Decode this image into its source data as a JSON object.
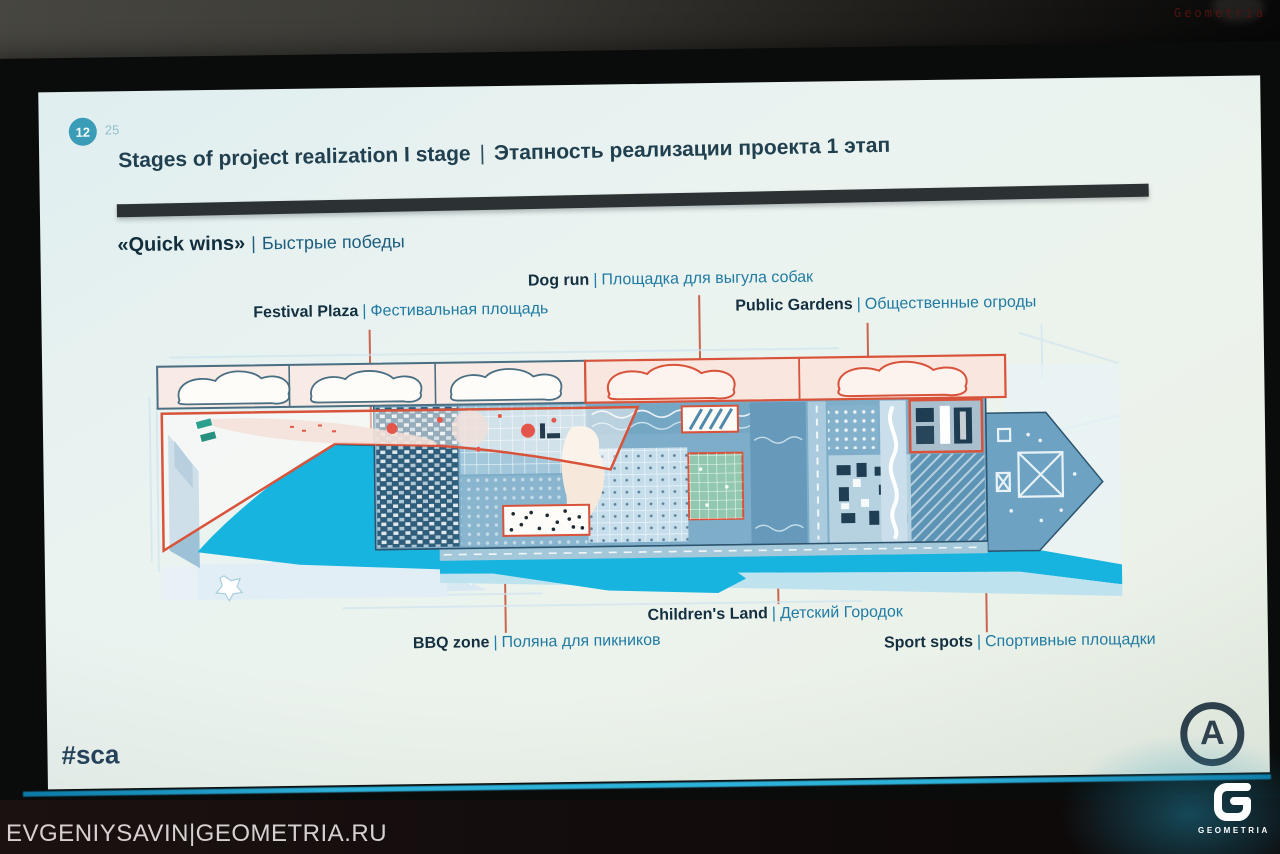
{
  "photo": {
    "corner_brand": "Geometria",
    "watermark": "EVGENIYSAVIN|GEOMETRIA.RU",
    "geometria_logo": {
      "label": "GEOMETRIA"
    }
  },
  "slide": {
    "page": {
      "current": "12",
      "next": "25"
    },
    "title": {
      "en": "Stages of project realization I stage",
      "sep": "|",
      "ru": "Этапность реализации проекта 1 этап"
    },
    "subtitle": {
      "en": "«Quick wins»",
      "sep": "|",
      "ru": "Быстрые победы"
    },
    "map_labels": {
      "dog_run": {
        "en": "Dog run",
        "sep": "|",
        "ru": "Площадка для выгула собак"
      },
      "festival_plaza": {
        "en": "Festival Plaza",
        "sep": "|",
        "ru": "Фестивальная площадь"
      },
      "public_gardens": {
        "en": "Public Gardens",
        "sep": "|",
        "ru": "Общественные огроды"
      },
      "childrens_land": {
        "en": "Children's Land",
        "sep": "|",
        "ru": "Детский Городок"
      },
      "bbq_zone": {
        "en": "BBQ zone",
        "sep": "|",
        "ru": "Поляна для пикников"
      },
      "sport_spots": {
        "en": "Sport spots",
        "sep": "|",
        "ru": "Спортивные площадки"
      }
    },
    "hashtag": "#sca",
    "logo_letter": "A",
    "colors": {
      "accent_red": "#d8533a",
      "water_cyan": "#17b4e0",
      "teal_label_text": "#1f7ba3",
      "dark_text": "#132f40",
      "title_bar": "#2c3134",
      "page_circle": "#3b9cb8",
      "screen_glow": "#2db2da"
    }
  }
}
